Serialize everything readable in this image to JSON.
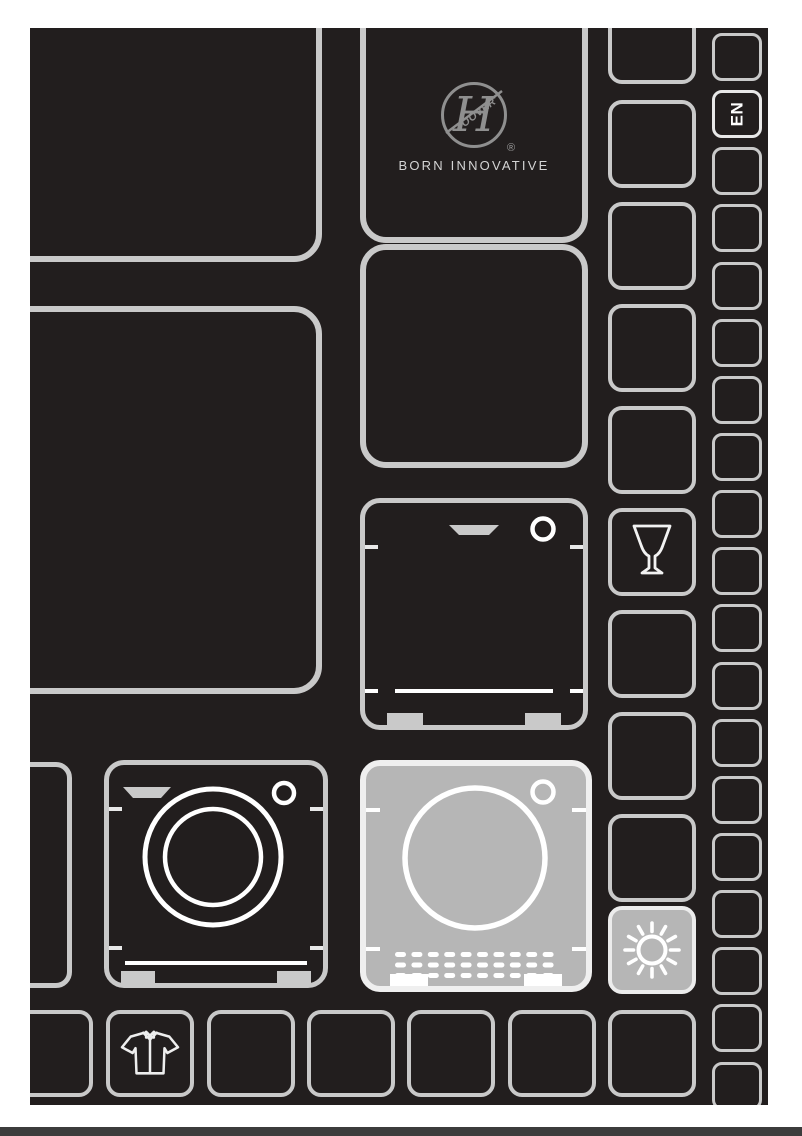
{
  "cover": {
    "language_badge": "EN",
    "brand": {
      "monogram": "H",
      "logo_word": "OOVER",
      "registered_mark": "®",
      "tagline": "BORN INNOVATIVE"
    },
    "icons": [
      "hoover-logo",
      "wine-glass-icon",
      "sun-icon",
      "washing-machine-icon",
      "dishwasher-icon",
      "tumble-dryer-icon",
      "shirt-icon"
    ],
    "highlighted_tiles": [
      "tumble-dryer-tile",
      "sun-tile"
    ]
  },
  "colors": {
    "canvas_bg": "#221e1e",
    "tile_border": "#c9c9c9",
    "highlight_fill": "#b6b6b6",
    "icon_stroke": "#ffffff",
    "logo_gray": "#8f8f8f",
    "tagline_color": "#d4d4d4",
    "bottom_bar": "#3c3c3c",
    "en_text": "#ffffff"
  }
}
